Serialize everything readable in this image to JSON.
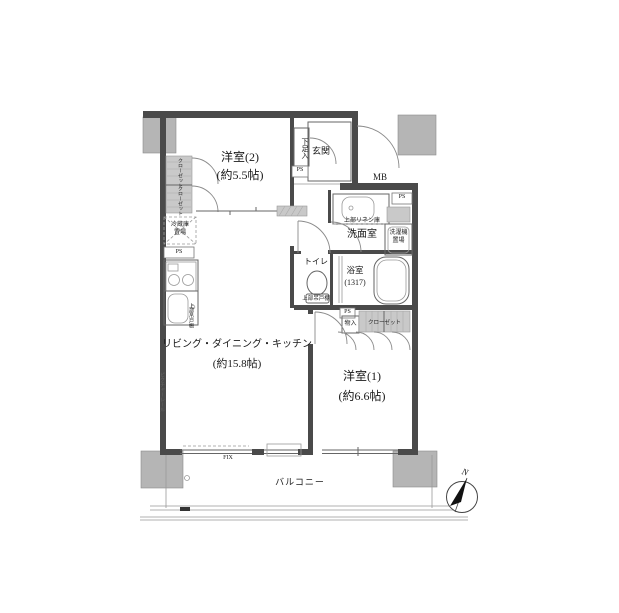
{
  "floor_plan": {
    "rooms": {
      "bedroom2": {
        "name": "洋室(2)",
        "size": "(約5.5帖)"
      },
      "bedroom1": {
        "name": "洋室(1)",
        "size": "(約6.6帖)"
      },
      "ldk": {
        "name": "リビング・ダイニング・キッチン",
        "size": "(約15.8帖)"
      },
      "washroom": {
        "name": "洗面室"
      },
      "bathroom": {
        "name": "浴室",
        "size": "(1317)"
      },
      "toilet": {
        "name": "トイレ"
      },
      "entrance": {
        "name": "玄関"
      },
      "balcony": {
        "name": "バルコニー"
      }
    },
    "features": {
      "shoe_cabinet": "下足入",
      "meter_box": "MB",
      "pipe_shaft": "PS",
      "linen_shelf": "上部リネン庫",
      "washer_line1": "洗濯機",
      "washer_line2": "置場",
      "upper_cabinet": "上部吊戸棚",
      "storage": "物入",
      "closet": "クローゼット",
      "fridge_line1": "冷蔵庫",
      "fridge_line2": "置場",
      "picture_rail": "ピクチャーレール",
      "fixed_window": "FIX",
      "north": "N"
    }
  }
}
